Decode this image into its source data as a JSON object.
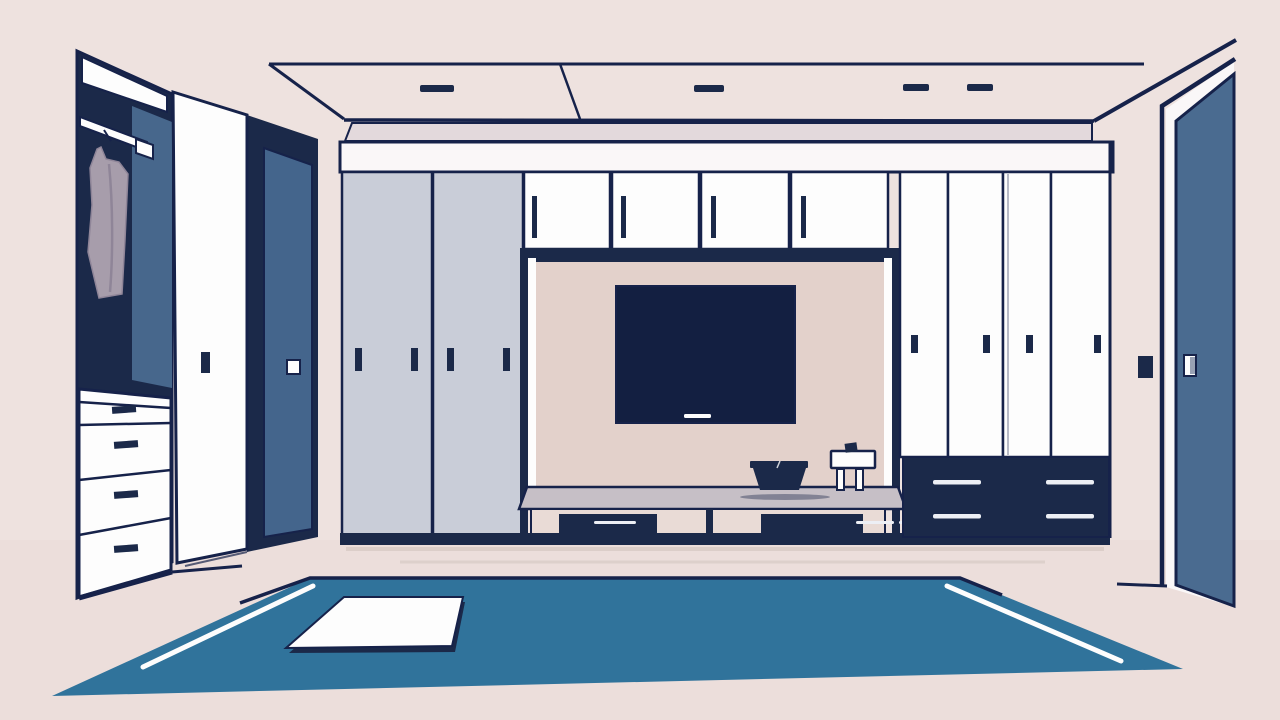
{
  "meta": {
    "description": "Flat vector illustration of a dressing room with built-in wardrobes, an open closet, a TV alcove with bench, a blue rug and an open door",
    "canvas": {
      "width": 1280,
      "height": 720
    }
  },
  "palette": {
    "wall": "#EEE2DF",
    "floor": "#ECDEDB",
    "outline": "#16224A",
    "navy": "#1B2949",
    "tv_screen": "#131F41",
    "white": "#FDFDFD",
    "off_white": "#FAF7F8",
    "steel_blue": "#4A6B90",
    "panel_blue": "#44658C",
    "closet_back_blue": "#47678C",
    "gray_door": "#C9CDD8",
    "alcove_back": "#E3D1CB",
    "bench_top": "#C6BFC6",
    "compartment": "#E9DBD6",
    "garment": "#A79DAB",
    "garment_fold": "#8F8598",
    "rug": "#30739B",
    "soffit": "#E3D9DC",
    "floor_shadow": "#DCCEC9",
    "handle_light": "#EDEFF5",
    "door_handle_shade": "#98A1B4"
  },
  "scene": {
    "ceiling": {
      "recessed_lights": 4,
      "panel_divider": true
    },
    "left_closet": {
      "open": true,
      "hanging_rod": true,
      "hanging_garments": 1,
      "drawer_count": 4,
      "open_white_door": true,
      "blue_sliding_panel": true
    },
    "center_unit": {
      "gray_sliding_doors": 2,
      "gray_door_handles": 4,
      "upper_cabinets": 4,
      "tv": true,
      "bench": true,
      "bench_drawers": 2,
      "objects_on_bench": [
        "storage-box",
        "small-stand"
      ]
    },
    "right_wardrobe": {
      "white_doors": 4,
      "drawer_unit": true,
      "drawer_handle_lines": 4
    },
    "right_wall": {
      "light_switch": true,
      "open_blue_door": true
    },
    "floor": {
      "rug": true,
      "rug_stripes": 2,
      "white_mat": true
    }
  }
}
